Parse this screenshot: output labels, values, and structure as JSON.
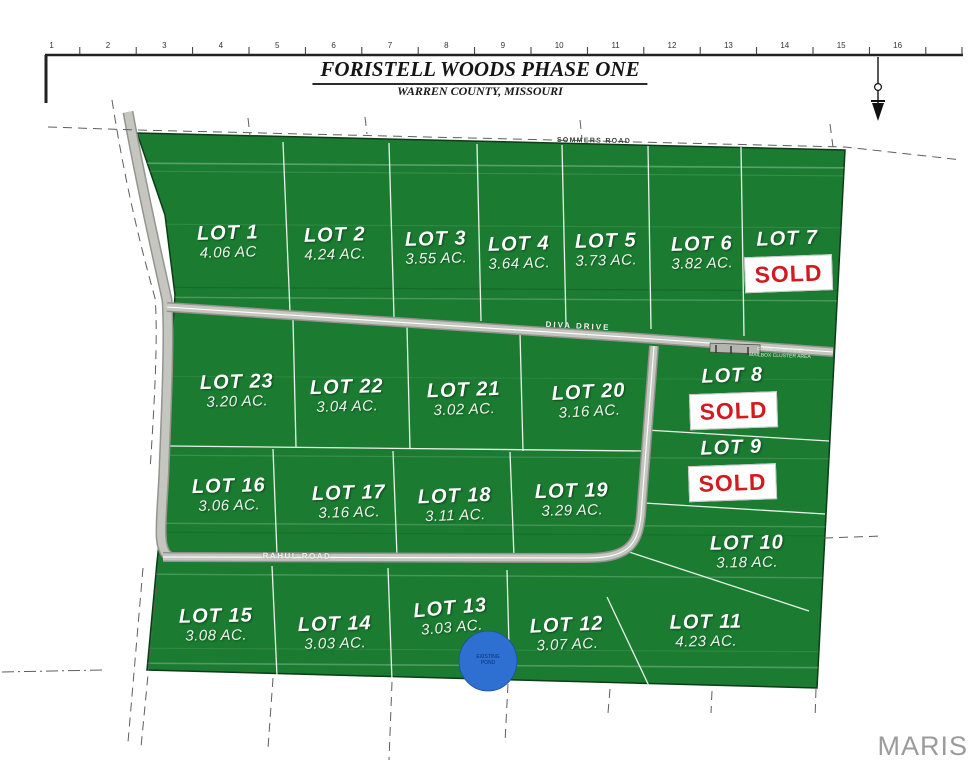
{
  "header": {
    "title": "FORISTELL WOODS PHASE ONE",
    "subtitle": "WARREN COUNTY, MISSOURI"
  },
  "ruler": {
    "numbers": [
      "1",
      "2",
      "3",
      "4",
      "5",
      "6",
      "7",
      "8",
      "9",
      "10",
      "11",
      "12",
      "13",
      "14",
      "15",
      "16"
    ]
  },
  "roads": {
    "sommers": "SOMMERS ROAD",
    "diva": "DIVA DRIVE",
    "rahul": "RAHUL ROAD"
  },
  "annotations": {
    "mailbox_line1": "COMMON GROUND",
    "mailbox_line2": "MAILBOX CLUSTER AREA",
    "pond_line1": "EXISTING",
    "pond_line2": "POND"
  },
  "watermark": "MARIS",
  "colors": {
    "lot_green": "#1b7c31",
    "road_gray": "#c6c6c1",
    "sold_red": "#d11a21",
    "pond_blue": "#2e6fd2",
    "watermark_gray": "#9b9b9b"
  },
  "lots": [
    {
      "label": "LOT 1",
      "acreage": "4.06 AC",
      "sold": false
    },
    {
      "label": "LOT 2",
      "acreage": "4.24 AC.",
      "sold": false
    },
    {
      "label": "LOT 3",
      "acreage": "3.55 AC.",
      "sold": false
    },
    {
      "label": "LOT 4",
      "acreage": "3.64 AC.",
      "sold": false
    },
    {
      "label": "LOT 5",
      "acreage": "3.73 AC.",
      "sold": false
    },
    {
      "label": "LOT 6",
      "acreage": "3.82 AC.",
      "sold": false
    },
    {
      "label": "LOT 7",
      "sold": true,
      "sold_label": "SOLD"
    },
    {
      "label": "LOT 8",
      "sold": true,
      "sold_label": "SOLD"
    },
    {
      "label": "LOT 9",
      "sold": true,
      "sold_label": "SOLD"
    },
    {
      "label": "LOT 10",
      "acreage": "3.18 AC.",
      "sold": false
    },
    {
      "label": "LOT 11",
      "acreage": "4.23 AC.",
      "sold": false
    },
    {
      "label": "LOT 12",
      "acreage": "3.07 AC.",
      "sold": false
    },
    {
      "label": "LOT 13",
      "acreage": "3.03 AC.",
      "sold": false
    },
    {
      "label": "LOT 14",
      "acreage": "3.03 AC.",
      "sold": false
    },
    {
      "label": "LOT 15",
      "acreage": "3.08 AC.",
      "sold": false
    },
    {
      "label": "LOT 16",
      "acreage": "3.06 AC.",
      "sold": false
    },
    {
      "label": "LOT 17",
      "acreage": "3.16 AC.",
      "sold": false
    },
    {
      "label": "LOT 18",
      "acreage": "3.11 AC.",
      "sold": false
    },
    {
      "label": "LOT 19",
      "acreage": "3.29 AC.",
      "sold": false
    },
    {
      "label": "LOT 20",
      "acreage": "3.16 AC.",
      "sold": false
    },
    {
      "label": "LOT 21",
      "acreage": "3.02 AC.",
      "sold": false
    },
    {
      "label": "LOT 22",
      "acreage": "3.04 AC.",
      "sold": false
    },
    {
      "label": "LOT 23",
      "acreage": "3.20 AC.",
      "sold": false
    }
  ]
}
